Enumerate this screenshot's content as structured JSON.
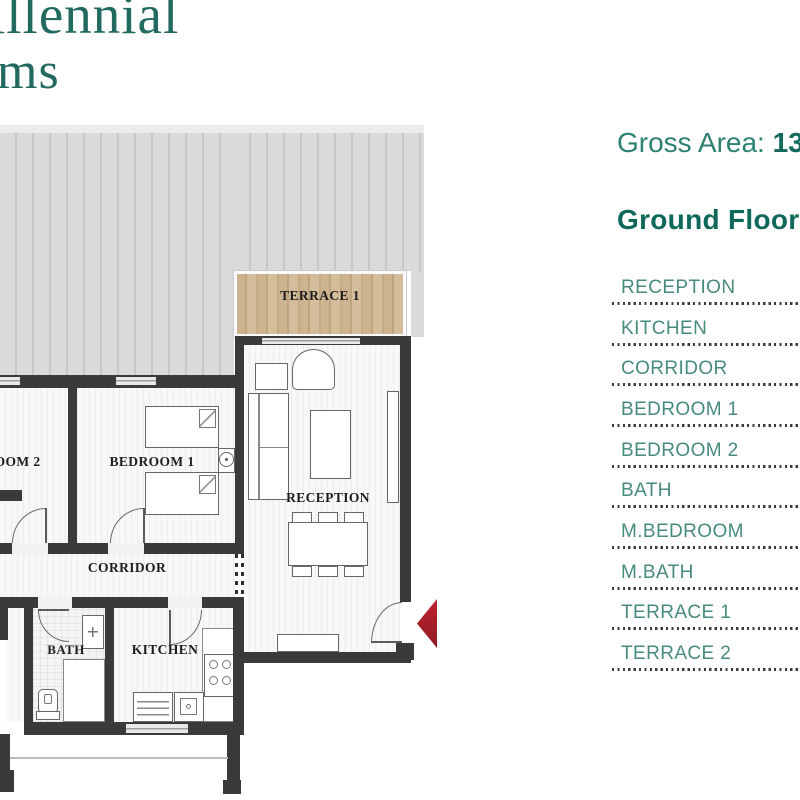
{
  "logo": {
    "line1": "illennial",
    "line2": "ms"
  },
  "info": {
    "gross_area_label": "Gross Area: ",
    "gross_area_value": "13",
    "floor_title": "Ground Floor",
    "accent_color": "#0f695b"
  },
  "legend": {
    "items": [
      "RECEPTION",
      "KITCHEN",
      "CORRIDOR",
      "BEDROOM 1",
      "BEDROOM 2",
      "BATH",
      "M.BEDROOM",
      "M.BATH",
      "TERRACE 1",
      "TERRACE 2"
    ]
  },
  "plan": {
    "labels": {
      "terrace1": "TERRACE 1",
      "reception": "RECEPTION",
      "bedroom1": "BEDROOM 1",
      "bedroom2": "BEDROOM 2",
      "corridor": "CORRIDOR",
      "bath": "BATH",
      "kitchen": "KITCHEN"
    },
    "colors": {
      "wall": "#3a3a3a",
      "roof": "#d8d8d8",
      "wood": "#c8b190",
      "entrance_arrow": "#a92430"
    }
  }
}
